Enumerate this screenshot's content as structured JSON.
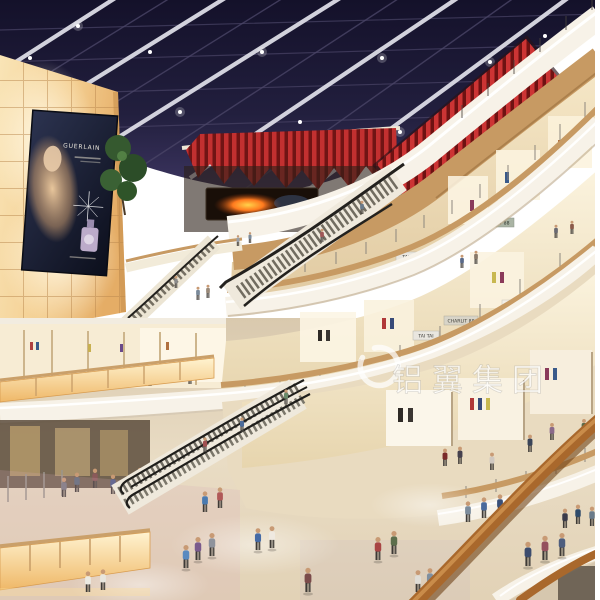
{
  "scene": {
    "watermark": {
      "icon": "swirl",
      "text": "铝翼集团"
    },
    "signage": {
      "theatres": "THEATRES",
      "billboard_brand": "GUERLAIN",
      "store_tai_tai_upper": "TAI TAI",
      "store_tai_tai_lower": "TAI TAI",
      "store_charlit_upper": "CHARLIT 88",
      "store_charlit_lower": "CHARLIT 88"
    },
    "palette": {
      "skylight_navy": "#1d1a33",
      "beam_white": "#dcdce6",
      "theatre_red": "#c23030",
      "fascia_white": "#f7f2e8",
      "wood_balustrade": "#c79a63",
      "handrail_wood": "#a9682c",
      "glow_wall_amber": "#f4cf92",
      "floor_beige": "#e7d9c0",
      "screen_fire_orange": "#ff8c2e"
    }
  }
}
